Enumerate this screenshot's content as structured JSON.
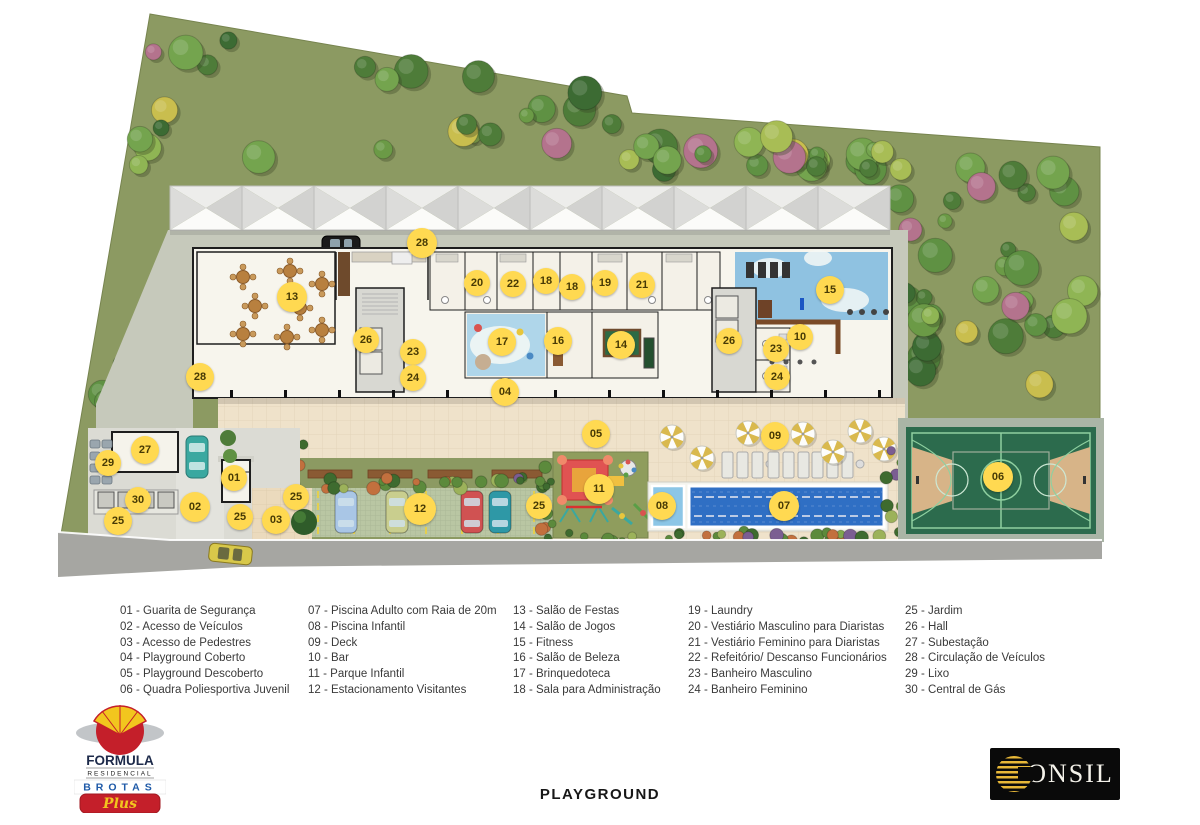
{
  "plan": {
    "title": "PLAYGROUND",
    "markers": [
      {
        "n": "28",
        "x": 422,
        "y": 243,
        "s": 30
      },
      {
        "n": "13",
        "x": 292,
        "y": 297,
        "s": 30
      },
      {
        "n": "20",
        "x": 477,
        "y": 283
      },
      {
        "n": "22",
        "x": 513,
        "y": 284
      },
      {
        "n": "18",
        "x": 546,
        "y": 281
      },
      {
        "n": "18",
        "x": 572,
        "y": 287
      },
      {
        "n": "19",
        "x": 605,
        "y": 283
      },
      {
        "n": "21",
        "x": 642,
        "y": 285
      },
      {
        "n": "15",
        "x": 830,
        "y": 290,
        "s": 28
      },
      {
        "n": "26",
        "x": 366,
        "y": 340
      },
      {
        "n": "23",
        "x": 413,
        "y": 352
      },
      {
        "n": "24",
        "x": 413,
        "y": 378
      },
      {
        "n": "17",
        "x": 502,
        "y": 342,
        "s": 28
      },
      {
        "n": "16",
        "x": 558,
        "y": 341,
        "s": 28
      },
      {
        "n": "14",
        "x": 621,
        "y": 345,
        "s": 28
      },
      {
        "n": "26",
        "x": 729,
        "y": 341
      },
      {
        "n": "23",
        "x": 776,
        "y": 349
      },
      {
        "n": "24",
        "x": 777,
        "y": 377
      },
      {
        "n": "10",
        "x": 800,
        "y": 337
      },
      {
        "n": "04",
        "x": 505,
        "y": 392,
        "s": 28
      },
      {
        "n": "28",
        "x": 200,
        "y": 377,
        "s": 28
      },
      {
        "n": "05",
        "x": 596,
        "y": 434,
        "s": 28
      },
      {
        "n": "09",
        "x": 775,
        "y": 436,
        "s": 28
      },
      {
        "n": "27",
        "x": 145,
        "y": 450,
        "s": 28
      },
      {
        "n": "29",
        "x": 108,
        "y": 463
      },
      {
        "n": "01",
        "x": 234,
        "y": 478
      },
      {
        "n": "30",
        "x": 138,
        "y": 500
      },
      {
        "n": "02",
        "x": 195,
        "y": 507,
        "s": 30
      },
      {
        "n": "25",
        "x": 118,
        "y": 521,
        "s": 28
      },
      {
        "n": "25",
        "x": 240,
        "y": 517
      },
      {
        "n": "03",
        "x": 276,
        "y": 520,
        "s": 28
      },
      {
        "n": "25",
        "x": 296,
        "y": 497
      },
      {
        "n": "12",
        "x": 420,
        "y": 509,
        "s": 32
      },
      {
        "n": "25",
        "x": 539,
        "y": 506
      },
      {
        "n": "11",
        "x": 599,
        "y": 489,
        "s": 30
      },
      {
        "n": "08",
        "x": 662,
        "y": 506,
        "s": 28
      },
      {
        "n": "07",
        "x": 784,
        "y": 506,
        "s": 30
      },
      {
        "n": "06",
        "x": 998,
        "y": 477,
        "s": 30
      }
    ]
  },
  "legend": {
    "columns": [
      [
        {
          "n": "01",
          "label": "Guarita de Segurança"
        },
        {
          "n": "02",
          "label": "Acesso de Veículos"
        },
        {
          "n": "03",
          "label": "Acesso de Pedestres"
        },
        {
          "n": "04",
          "label": "Playground Coberto"
        },
        {
          "n": "05",
          "label": "Playground Descoberto"
        },
        {
          "n": "06",
          "label": "Quadra Poliesportiva Juvenil"
        }
      ],
      [
        {
          "n": "07",
          "label": "Piscina Adulto com Raia de 20m"
        },
        {
          "n": "08",
          "label": "Piscina Infantil"
        },
        {
          "n": "09",
          "label": "Deck"
        },
        {
          "n": "10",
          "label": "Bar"
        },
        {
          "n": "11",
          "label": "Parque Infantil"
        },
        {
          "n": "12",
          "label": "Estacionamento Visitantes"
        }
      ],
      [
        {
          "n": "13",
          "label": "Salão de Festas"
        },
        {
          "n": "14",
          "label": "Salão de Jogos"
        },
        {
          "n": "15",
          "label": "Fitness"
        },
        {
          "n": "16",
          "label": "Salão de Beleza"
        },
        {
          "n": "17",
          "label": "Brinquedoteca"
        },
        {
          "n": "18",
          "label": "Sala para Administração"
        }
      ],
      [
        {
          "n": "19",
          "label": "Laundry"
        },
        {
          "n": "20",
          "label": "Vestiário Masculino para Diaristas"
        },
        {
          "n": "21",
          "label": "Vestiário Feminino para Diaristas"
        },
        {
          "n": "22",
          "label": "Refeitório/ Descanso Funcionários"
        },
        {
          "n": "23",
          "label": "Banheiro Masculino"
        },
        {
          "n": "24",
          "label": "Banheiro Feminino"
        }
      ],
      [
        {
          "n": "25",
          "label": "Jardim"
        },
        {
          "n": "26",
          "label": "Hall"
        },
        {
          "n": "27",
          "label": "Subestação"
        },
        {
          "n": "28",
          "label": "Circulação de Veículos"
        },
        {
          "n": "29",
          "label": "Lixo"
        },
        {
          "n": "30",
          "label": "Central de Gás"
        }
      ]
    ]
  },
  "branding": {
    "formula": {
      "line1": "FORMULA",
      "line2": "RESIDENCIAL",
      "line3": "BROTAS",
      "line4": "Plus"
    },
    "consil": {
      "name": "CONSIL",
      "wordmark_rest": "ONSIL"
    }
  },
  "colors": {
    "marker": "#FFD951",
    "vegetation": "#8C9A62",
    "pool_adult": "#2F6FC4",
    "pool_kids": "#8CC6E6",
    "court": "#2C6B4D",
    "terrace": "#EFE2CA",
    "accent_red": "#C41F2A"
  }
}
